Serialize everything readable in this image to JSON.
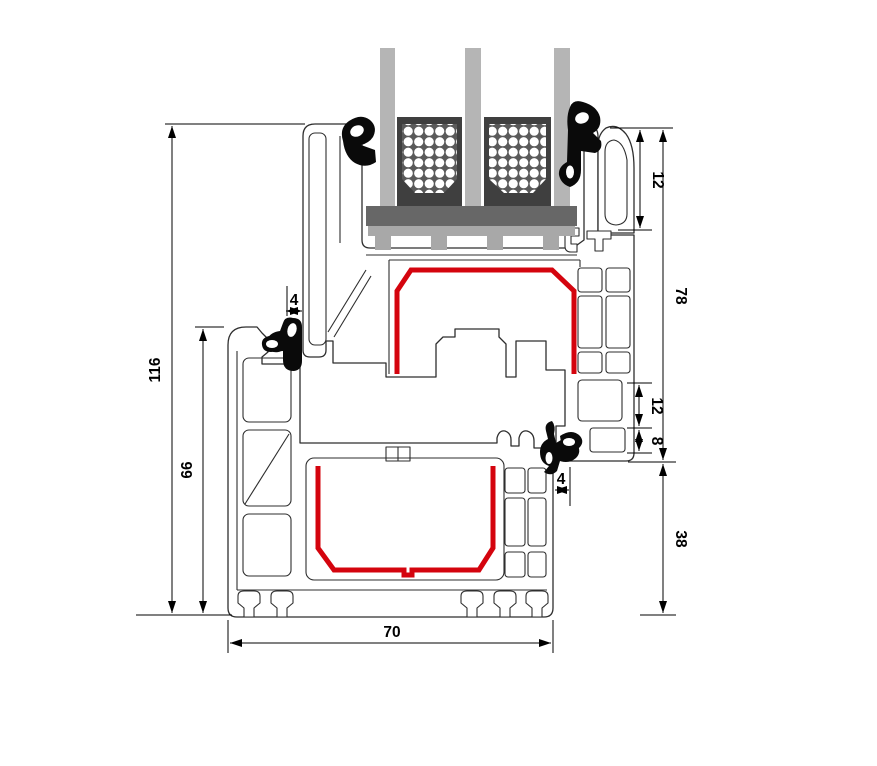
{
  "diagram": {
    "dims": {
      "overall_height": "116",
      "frame_height": "66",
      "gap_top": "4",
      "glazing_rebate_height": "12",
      "sash_overall_height": "78",
      "hardware_groove_height": "12",
      "groove_to_bottom": "8",
      "gap_side": "4",
      "frame_face_height": "38",
      "profile_depth": "70"
    },
    "colors": {
      "steel_red": "#d4040e",
      "glass": "#b5b5b5",
      "spacer_body": "#3f3f3f",
      "spacer_shield": "#5a5a5a",
      "setting_block": "#676767",
      "glazing_bridge": "#a8a8a8",
      "gasket_black": "#0a0a0a",
      "outline": "#2e2e2e"
    }
  }
}
